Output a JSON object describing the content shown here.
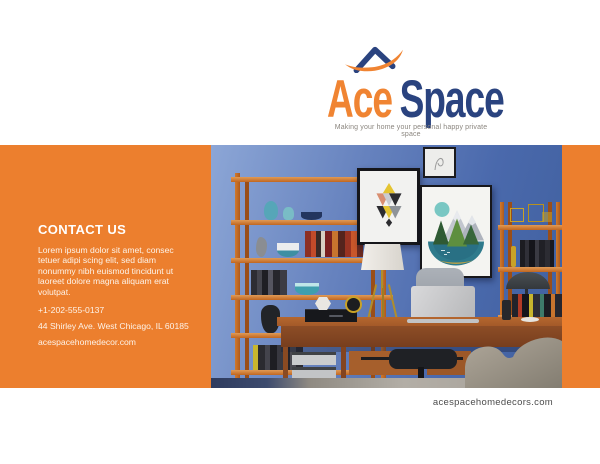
{
  "theme": {
    "accent_orange": "#EC7F2E",
    "logo_orange": "#F08432",
    "logo_navy": "#2A437F",
    "tagline_gray": "#8B867F",
    "footer_gray": "#4C4C4C",
    "wall_blue_light": "#8CA6D6",
    "wall_blue_dark": "#40609E"
  },
  "logo": {
    "word1": "Ace",
    "word2": "Space",
    "tagline": "Making your home your personal happy private space",
    "icon": "roof-swoosh-icon"
  },
  "contact": {
    "heading": "CONTACT US",
    "body_lines": [
      "Lorem ipsum dolor sit amet, consec",
      "tetuer adipi scing elit, sed diam",
      "nonummy nibh euismod tincidunt ut",
      "laoreet dolore magna aliquam erat",
      "volutpat."
    ],
    "phone": "+1-202-555-0137",
    "address": "44 Shirley Ave. West Chicago, IL 60185",
    "website": "acespacehomedecor.com"
  },
  "footer": {
    "website": "acespacehomedecors.com"
  },
  "photo": {
    "alt": "Home office with blue wall, wooden ladder shelves, framed geometric art prints, desk with laptop, white table lamp, office chair and beige armchair"
  }
}
